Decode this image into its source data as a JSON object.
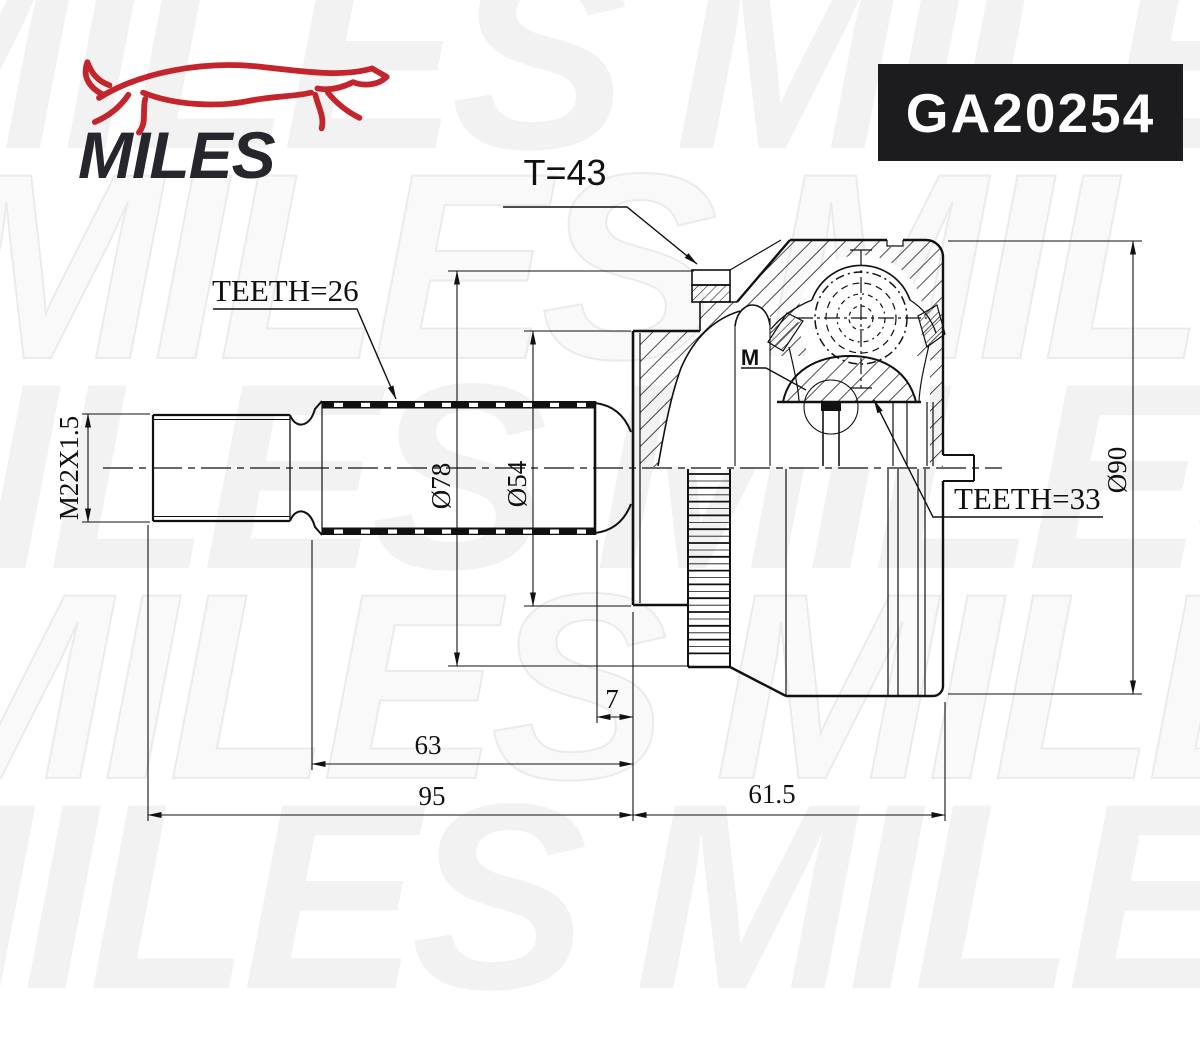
{
  "brand": {
    "logo_text": "MILES"
  },
  "part_number": "GA20254",
  "watermark": {
    "text": "MILES"
  },
  "drawing": {
    "callouts": {
      "abs_ring_teeth": "T=43",
      "inner_spline_teeth": "TEETH=26",
      "outer_spline_teeth": "TEETH=33",
      "vent_mark": "M"
    },
    "dimensions": {
      "thread_size": "M22X1.5",
      "abs_ring_diameter": "Ø78",
      "bell_face_diameter": "Ø54",
      "housing_diameter": "Ø90",
      "step_length": "7",
      "boot_seat_length": "63",
      "shaft_length": "95",
      "housing_length": "61.5"
    }
  },
  "colors": {
    "accent_red": "#c4242b",
    "ink": "#111111",
    "panel_black": "#1c1c1e",
    "watermark_gray": "#f2f2f2"
  }
}
